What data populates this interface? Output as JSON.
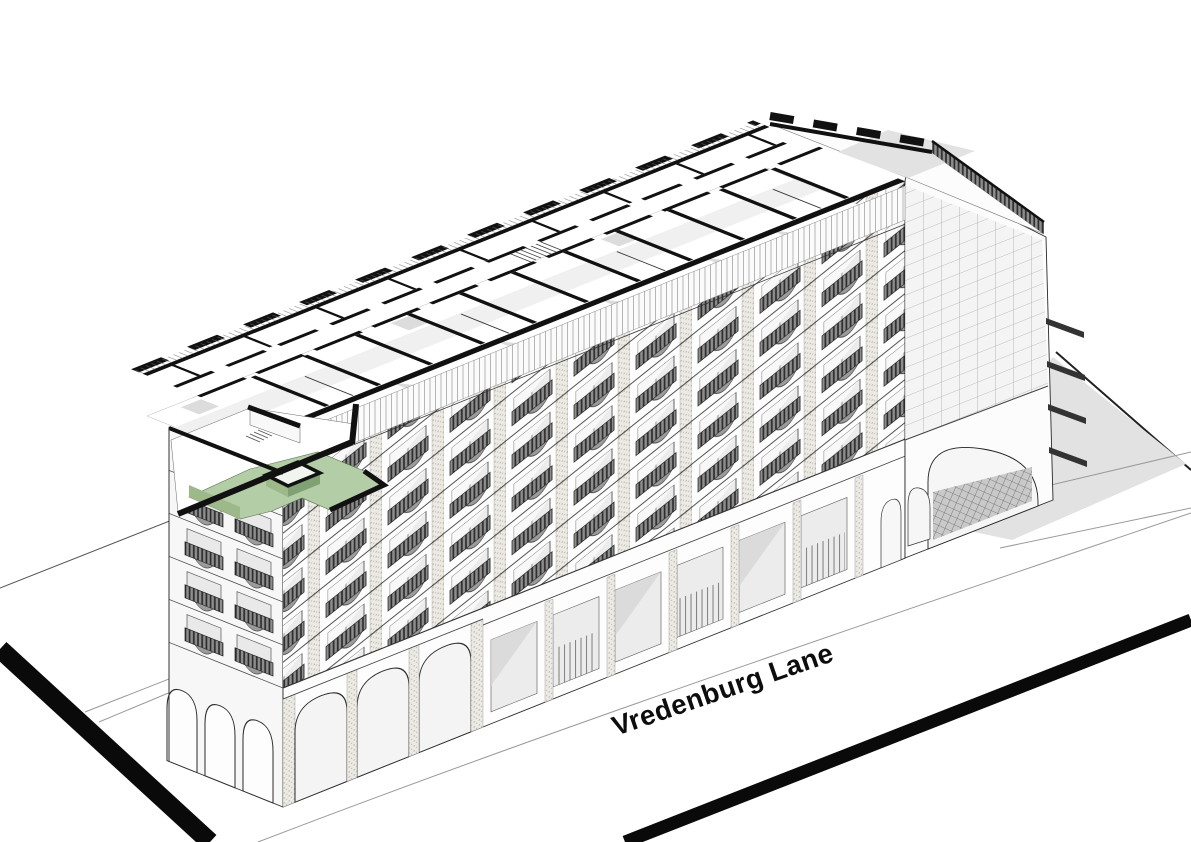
{
  "figure": {
    "street_label": "Vredenburg Lane"
  },
  "colors": {
    "unit_floor": "#b3cda7",
    "unit_wall": "#9db989",
    "unit_wall_dark": "#7fa173",
    "ink": "#141414",
    "ground_shadow": "#e2e2e2",
    "railing": "#3a3a3a"
  }
}
